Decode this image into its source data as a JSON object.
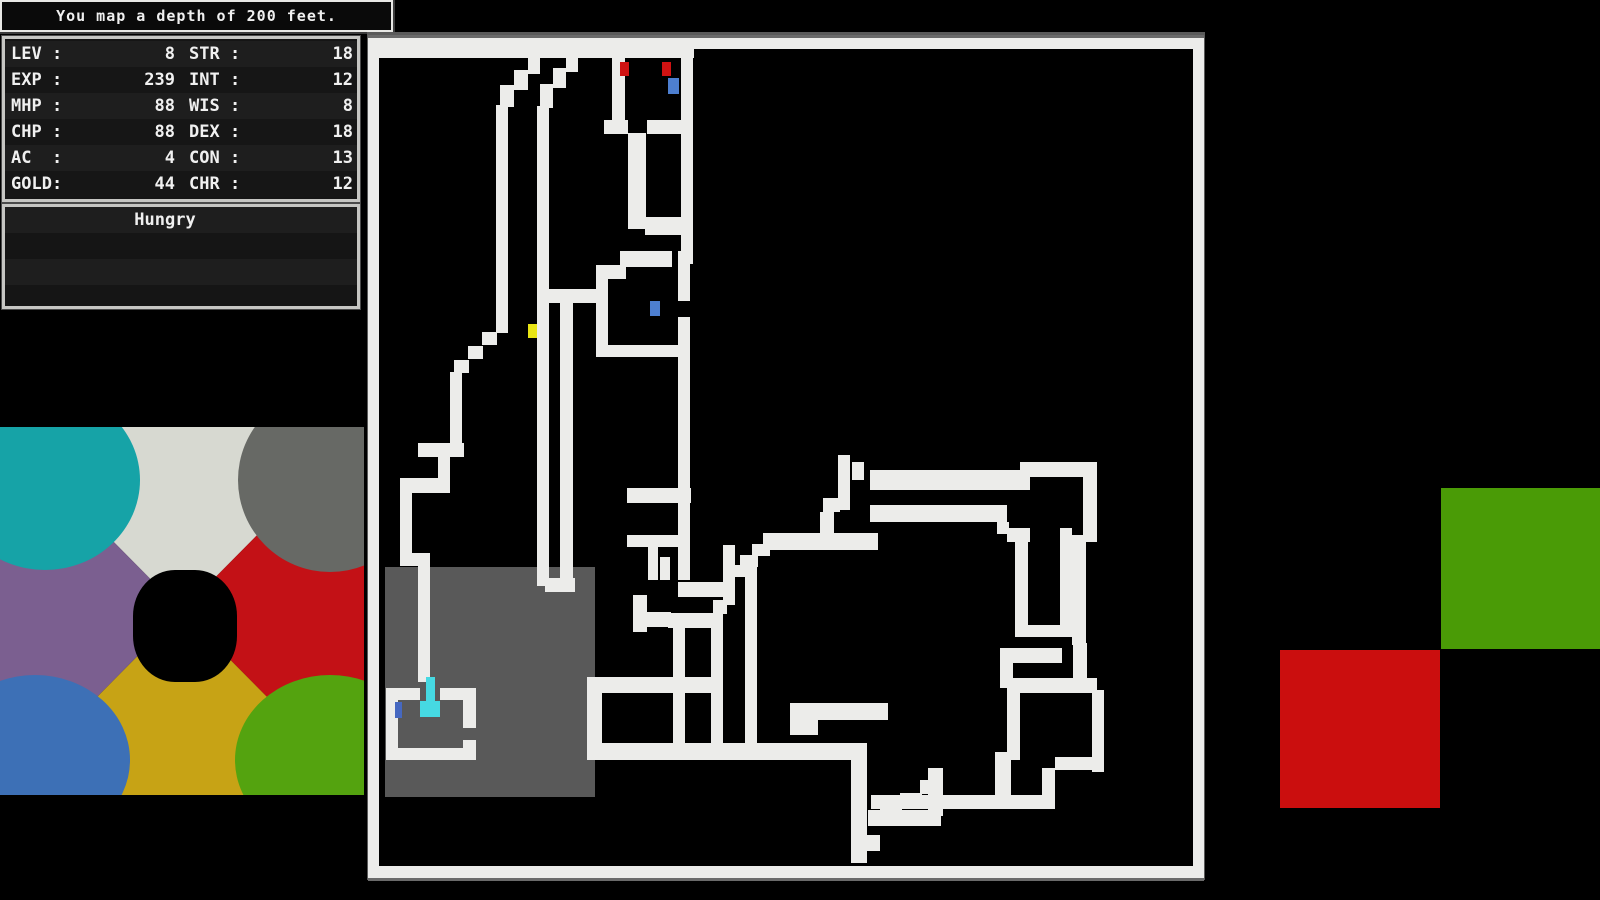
{
  "message_bar": {
    "text": "You map a depth of 200 feet."
  },
  "stats_panel": {
    "rows": [
      {
        "label_left": "LEV :",
        "value_left": "8",
        "label_right": "STR :",
        "value_right": "18"
      },
      {
        "label_left": "EXP :",
        "value_left": "239",
        "label_right": "INT :",
        "value_right": "12"
      },
      {
        "label_left": "MHP :",
        "value_left": "88",
        "label_right": "WIS :",
        "value_right": "8"
      },
      {
        "label_left": "CHP :",
        "value_left": "88",
        "label_right": "DEX :",
        "value_right": "18"
      },
      {
        "label_left": "AC  :",
        "value_left": "4",
        "label_right": "CON :",
        "value_right": "13"
      },
      {
        "label_left": "GOLD:",
        "value_left": "44",
        "label_right": "CHR :",
        "value_right": "12"
      }
    ]
  },
  "status_panel": {
    "text": "Hungry"
  },
  "map": {
    "palette": {
      "w": "#ececea",
      "f": "#6a6a6a",
      "g": "#595959",
      "y": "#e8e414",
      "c": "#46d9e2",
      "r": "#d01212",
      "b": "#4d7fd0",
      "d": "#4668c0",
      "k": "#000000"
    },
    "tiles": [
      [
        0,
        0,
        836,
        3,
        "f"
      ],
      [
        0,
        843,
        836,
        3,
        "f"
      ],
      [
        0,
        3,
        836,
        11,
        "w"
      ],
      [
        0,
        3,
        11,
        840,
        "w"
      ],
      [
        825,
        3,
        11,
        840,
        "w"
      ],
      [
        0,
        831,
        836,
        12,
        "w"
      ],
      [
        17,
        532,
        210,
        230,
        "g"
      ],
      [
        10,
        11,
        240,
        12,
        "w"
      ],
      [
        160,
        23,
        12,
        16,
        "w"
      ],
      [
        146,
        35,
        14,
        20,
        "w"
      ],
      [
        132,
        50,
        14,
        22,
        "w"
      ],
      [
        128,
        70,
        12,
        228,
        "w"
      ],
      [
        198,
        23,
        12,
        14,
        "w"
      ],
      [
        185,
        33,
        13,
        20,
        "w"
      ],
      [
        172,
        49,
        13,
        24,
        "w"
      ],
      [
        169,
        71,
        12,
        480,
        "w"
      ],
      [
        177,
        543,
        30,
        14,
        "w"
      ],
      [
        192,
        268,
        13,
        283,
        "w"
      ],
      [
        181,
        254,
        47,
        14,
        "w"
      ],
      [
        236,
        11,
        90,
        12,
        "w"
      ],
      [
        244,
        11,
        13,
        88,
        "w"
      ],
      [
        313,
        11,
        12,
        186,
        "w"
      ],
      [
        236,
        85,
        24,
        14,
        "w"
      ],
      [
        279,
        85,
        46,
        14,
        "w"
      ],
      [
        260,
        98,
        18,
        96,
        "w"
      ],
      [
        277,
        182,
        48,
        18,
        "w"
      ],
      [
        313,
        195,
        12,
        34,
        "w"
      ],
      [
        228,
        230,
        30,
        14,
        "w"
      ],
      [
        252,
        216,
        52,
        16,
        "w"
      ],
      [
        228,
        230,
        12,
        92,
        "w"
      ],
      [
        228,
        310,
        82,
        12,
        "w"
      ],
      [
        310,
        216,
        12,
        240,
        "w"
      ],
      [
        310,
        266,
        12,
        16,
        "k"
      ],
      [
        310,
        445,
        12,
        100,
        "w"
      ],
      [
        259,
        453,
        64,
        15,
        "w"
      ],
      [
        259,
        500,
        53,
        12,
        "w"
      ],
      [
        280,
        510,
        10,
        35,
        "w"
      ],
      [
        292,
        522,
        10,
        23,
        "w"
      ],
      [
        265,
        560,
        14,
        37,
        "w"
      ],
      [
        265,
        577,
        38,
        15,
        "w"
      ],
      [
        300,
        578,
        55,
        15,
        "w"
      ],
      [
        305,
        592,
        12,
        116,
        "w"
      ],
      [
        343,
        592,
        12,
        116,
        "w"
      ],
      [
        377,
        532,
        12,
        176,
        "w"
      ],
      [
        310,
        547,
        57,
        15,
        "w"
      ],
      [
        355,
        510,
        12,
        60,
        "w"
      ],
      [
        345,
        565,
        14,
        14,
        "w"
      ],
      [
        219,
        642,
        125,
        16,
        "w"
      ],
      [
        219,
        642,
        15,
        83,
        "w"
      ],
      [
        219,
        708,
        270,
        17,
        "w"
      ],
      [
        114,
        297,
        15,
        13,
        "w"
      ],
      [
        100,
        311,
        15,
        13,
        "w"
      ],
      [
        86,
        325,
        15,
        13,
        "w"
      ],
      [
        82,
        337,
        12,
        78,
        "w"
      ],
      [
        50,
        408,
        46,
        14,
        "w"
      ],
      [
        70,
        422,
        12,
        24,
        "w"
      ],
      [
        32,
        443,
        50,
        15,
        "w"
      ],
      [
        32,
        456,
        12,
        68,
        "w"
      ],
      [
        32,
        518,
        30,
        13,
        "w"
      ],
      [
        50,
        525,
        12,
        122,
        "w"
      ],
      [
        18,
        653,
        34,
        12,
        "w"
      ],
      [
        72,
        653,
        35,
        12,
        "w"
      ],
      [
        18,
        653,
        12,
        72,
        "w"
      ],
      [
        18,
        713,
        90,
        12,
        "w"
      ],
      [
        95,
        653,
        13,
        40,
        "w"
      ],
      [
        95,
        705,
        13,
        20,
        "w"
      ],
      [
        58,
        642,
        9,
        28,
        "c"
      ],
      [
        52,
        666,
        20,
        16,
        "c"
      ],
      [
        27,
        667,
        7,
        16,
        "d"
      ],
      [
        160,
        289,
        9,
        14,
        "y"
      ],
      [
        252,
        27,
        9,
        14,
        "r"
      ],
      [
        294,
        27,
        9,
        14,
        "r"
      ],
      [
        300,
        43,
        11,
        16,
        "b"
      ],
      [
        282,
        266,
        10,
        15,
        "b"
      ],
      [
        470,
        420,
        12,
        55,
        "w"
      ],
      [
        484,
        427,
        12,
        18,
        "w"
      ],
      [
        455,
        463,
        17,
        14,
        "w"
      ],
      [
        452,
        477,
        14,
        24,
        "w"
      ],
      [
        395,
        498,
        115,
        17,
        "w"
      ],
      [
        384,
        509,
        18,
        12,
        "w"
      ],
      [
        372,
        520,
        18,
        12,
        "w"
      ],
      [
        365,
        530,
        14,
        12,
        "w"
      ],
      [
        502,
        435,
        160,
        20,
        "w"
      ],
      [
        652,
        427,
        77,
        15,
        "w"
      ],
      [
        715,
        427,
        14,
        80,
        "w"
      ],
      [
        704,
        500,
        14,
        110,
        "w"
      ],
      [
        705,
        608,
        14,
        50,
        "w"
      ],
      [
        724,
        655,
        12,
        82,
        "w"
      ],
      [
        502,
        470,
        137,
        17,
        "w"
      ],
      [
        629,
        487,
        12,
        12,
        "w"
      ],
      [
        639,
        493,
        23,
        14,
        "w"
      ],
      [
        647,
        505,
        13,
        97,
        "w"
      ],
      [
        692,
        493,
        12,
        109,
        "w"
      ],
      [
        647,
        590,
        57,
        12,
        "w"
      ],
      [
        632,
        613,
        62,
        15,
        "w"
      ],
      [
        632,
        613,
        13,
        40,
        "w"
      ],
      [
        645,
        643,
        84,
        15,
        "w"
      ],
      [
        639,
        650,
        13,
        75,
        "w"
      ],
      [
        687,
        722,
        48,
        13,
        "w"
      ],
      [
        674,
        733,
        13,
        30,
        "w"
      ],
      [
        627,
        717,
        16,
        45,
        "w"
      ],
      [
        503,
        760,
        184,
        14,
        "w"
      ],
      [
        552,
        745,
        22,
        14,
        "w"
      ],
      [
        532,
        758,
        22,
        14,
        "w"
      ],
      [
        512,
        770,
        22,
        14,
        "w"
      ],
      [
        422,
        668,
        98,
        17,
        "w"
      ],
      [
        422,
        680,
        28,
        20,
        "w"
      ],
      [
        483,
        708,
        16,
        120,
        "w"
      ],
      [
        500,
        775,
        73,
        16,
        "w"
      ],
      [
        560,
        733,
        15,
        48,
        "w"
      ],
      [
        484,
        800,
        28,
        16,
        "w"
      ]
    ]
  },
  "art_panel": {
    "colors": {
      "top": "#d7d9d1",
      "right": "#c31116",
      "bottom": "#c7a315",
      "left": "#7b5f90",
      "ellipse_top_left": "#16a3a7",
      "ellipse_top_right": "#676965",
      "ellipse_bottom_left": "#3d70b6",
      "ellipse_bottom_right": "#54a30f",
      "center": "#000000"
    }
  },
  "right_squares": {
    "green": "#4a9b06",
    "red": "#cb0e0e"
  }
}
